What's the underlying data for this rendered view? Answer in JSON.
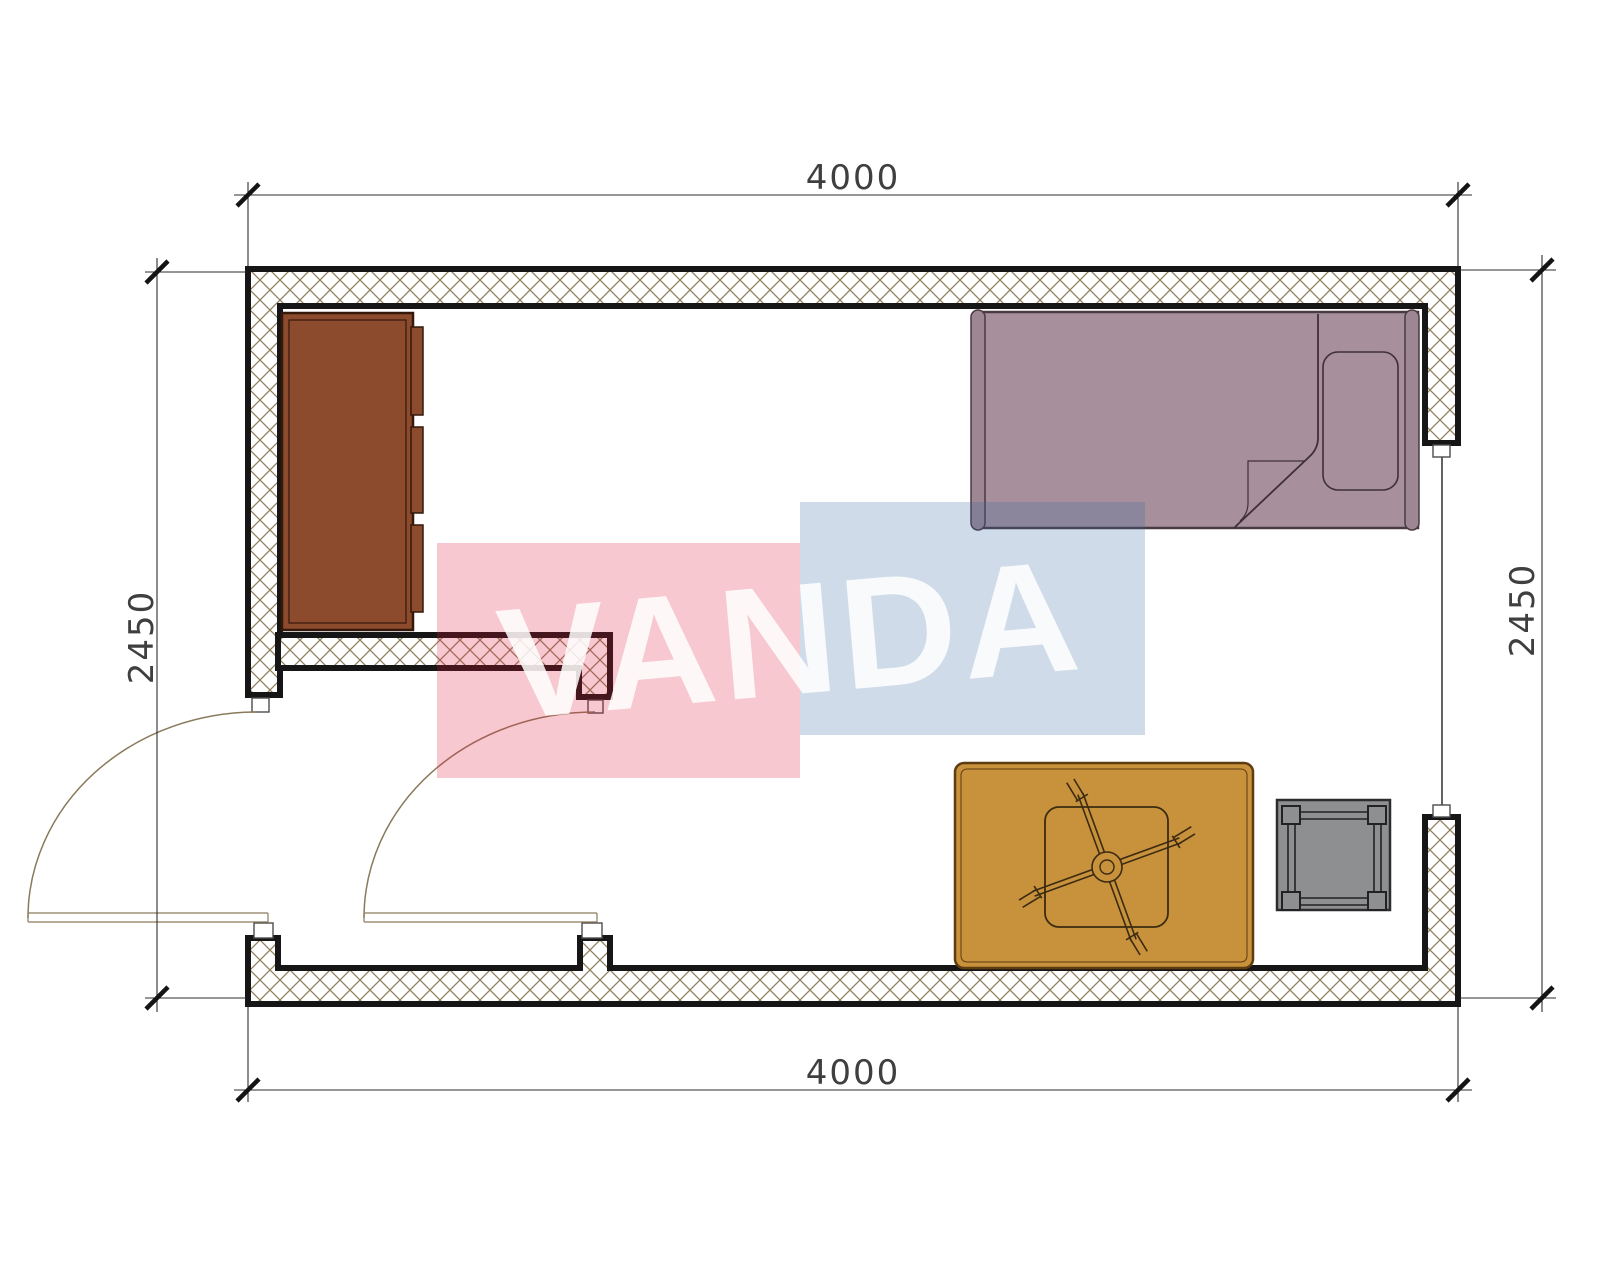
{
  "plan": {
    "type": "floor-plan",
    "dimensions": {
      "top": "4000",
      "bottom": "4000",
      "left": "2450",
      "right": "2450"
    },
    "watermark": {
      "text": "VANDA",
      "red": "#e0183c",
      "blue": "#3868a4",
      "text_color": "#ffffff"
    },
    "colors": {
      "background": "#ffffff",
      "wall_outline": "#161616",
      "hatch_line": "#8f815f",
      "wardrobe": "#8c4b2c",
      "wardrobe_outline": "#35180a",
      "bed": "#a7909b",
      "bed_posts": "#9d8792",
      "bed_outline": "#4a3a42",
      "desk": "#c8913c",
      "desk_outline": "#5d3c10",
      "stool": "#8e8f91",
      "stool_outline": "#2c2c2e",
      "door_arc": "#8a7a5c",
      "dimension_line": "#2e2e2e",
      "dimension_text": "#3f3f3f"
    },
    "furniture": [
      {
        "name": "wardrobe"
      },
      {
        "name": "single-bed"
      },
      {
        "name": "pillow"
      },
      {
        "name": "desk-table"
      },
      {
        "name": "office-chair"
      },
      {
        "name": "stool-table"
      }
    ],
    "openings": [
      {
        "name": "entry-door"
      },
      {
        "name": "interior-door"
      },
      {
        "name": "window"
      }
    ]
  }
}
